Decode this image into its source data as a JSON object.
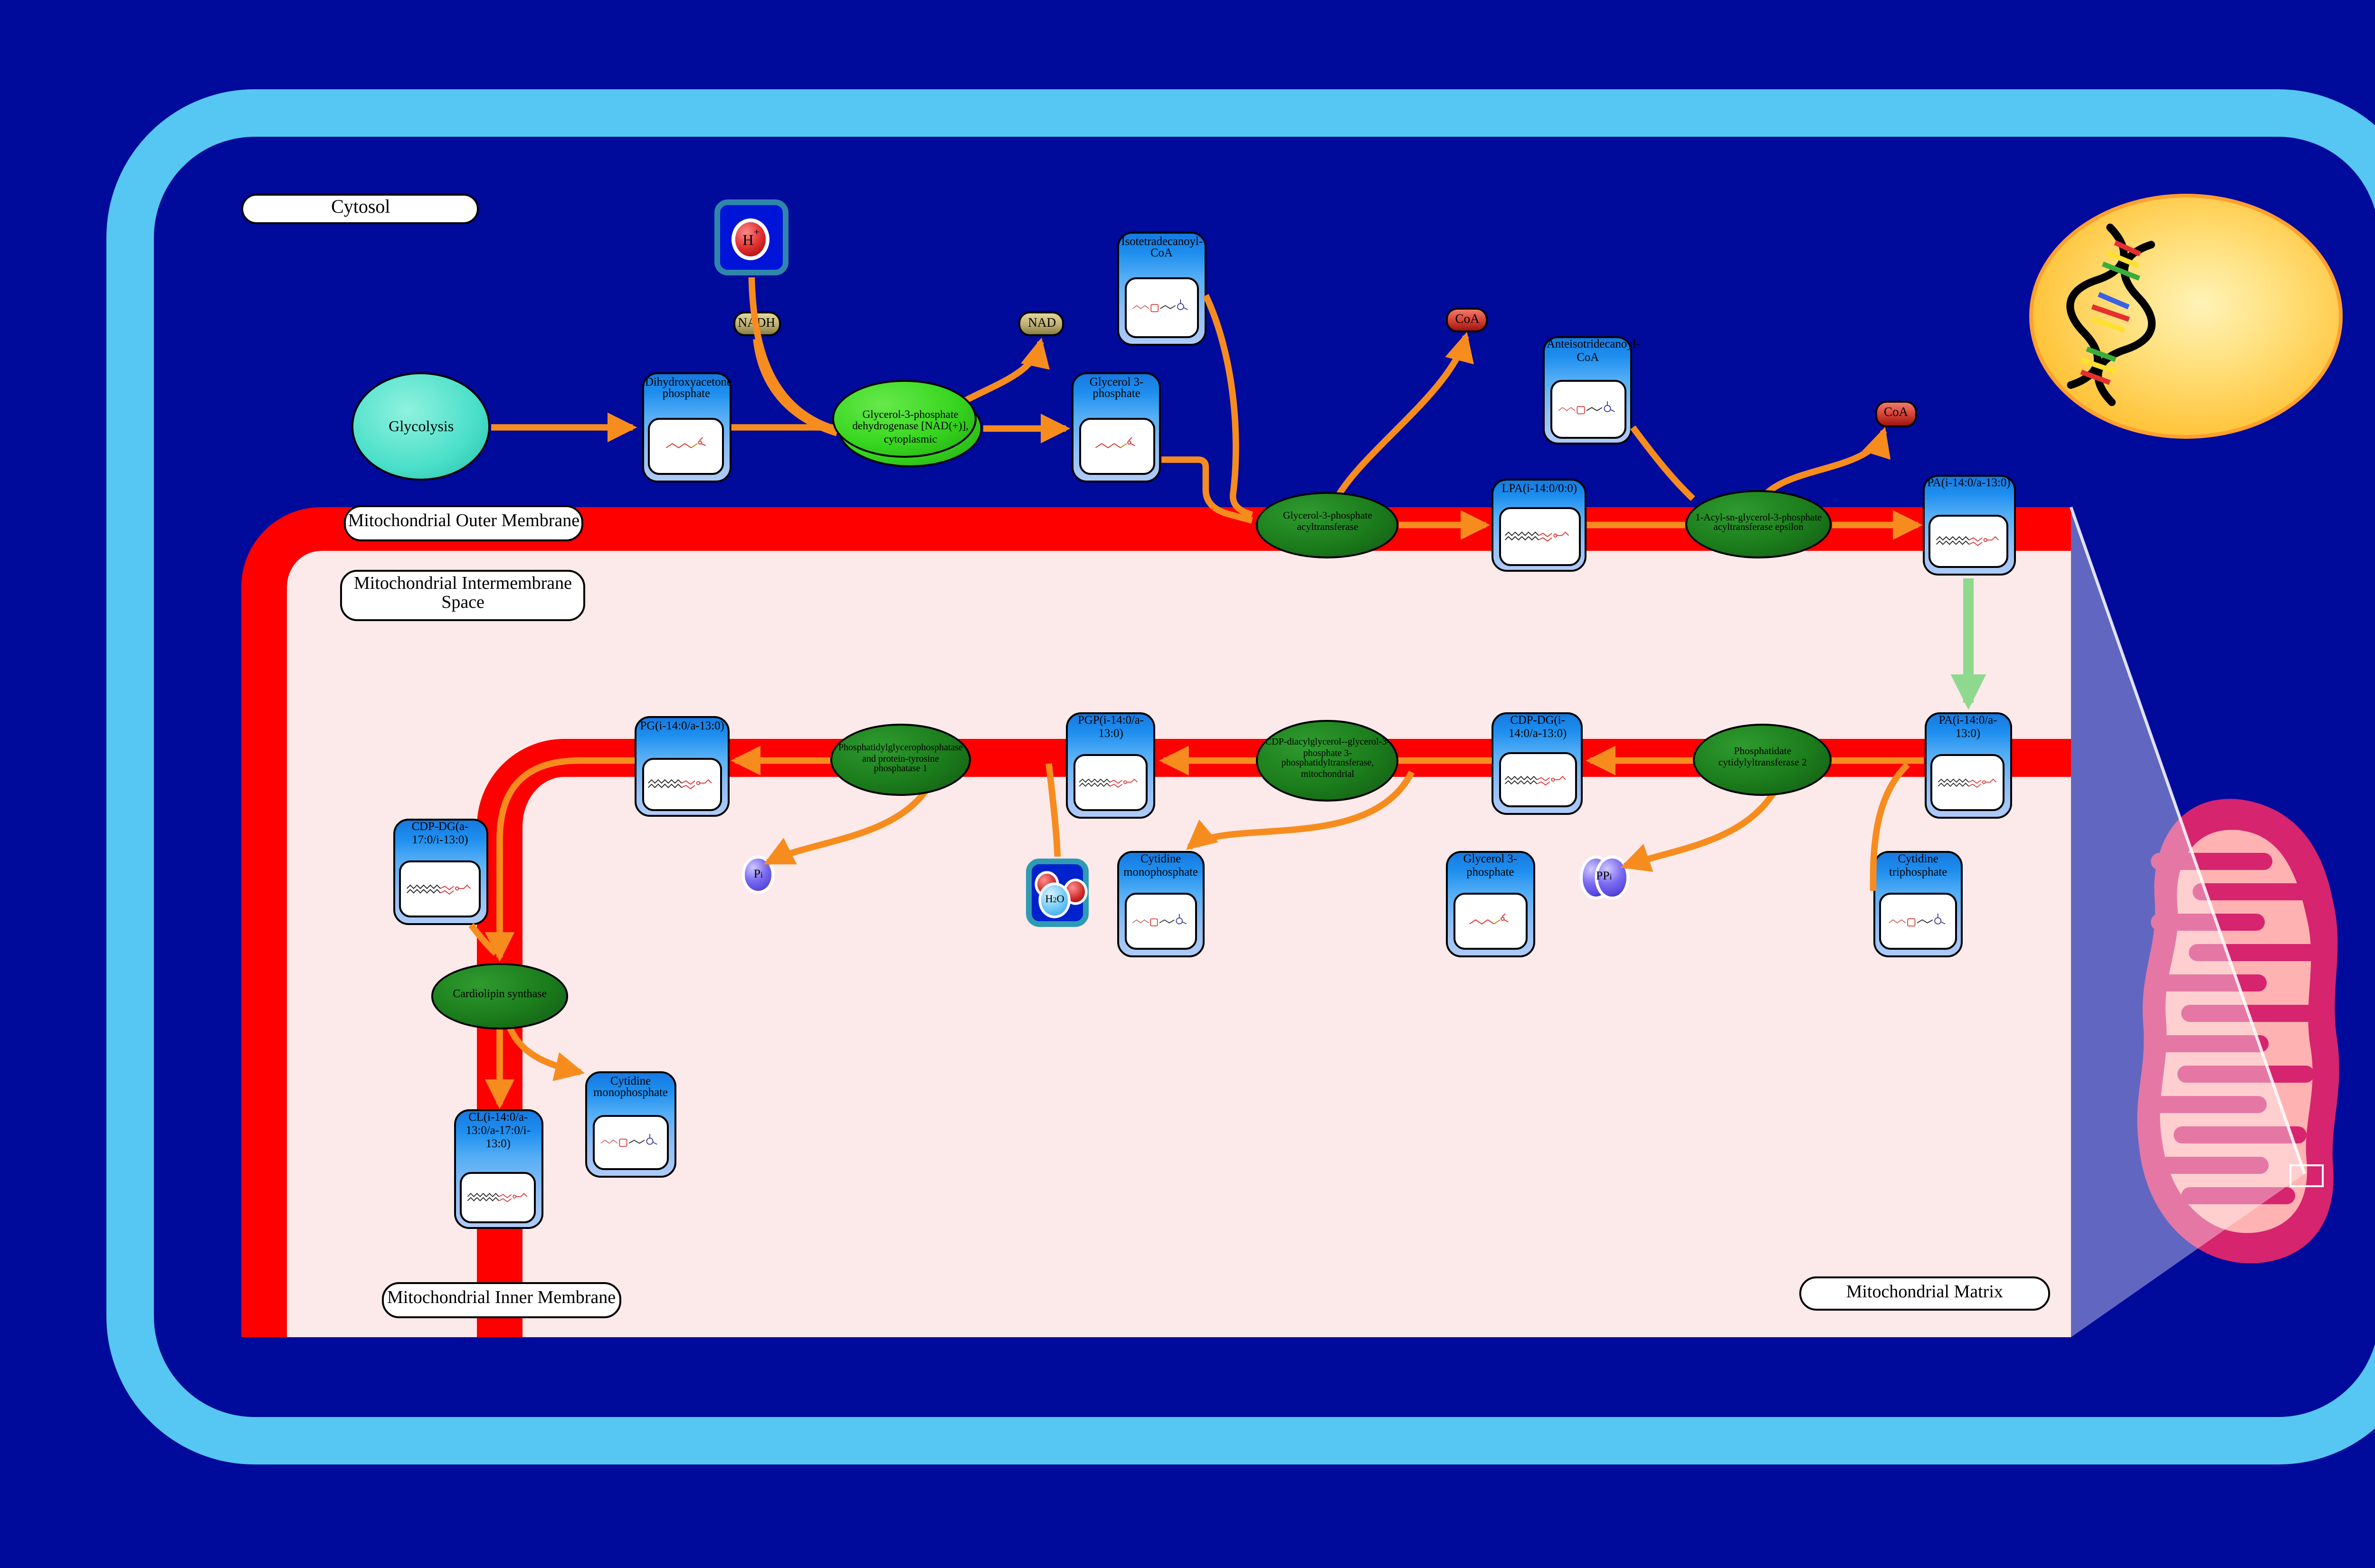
{
  "compartments": {
    "cytosol": "Cytosol",
    "outer_membrane": "Mitochondrial Outer Membrane",
    "intermembrane_space": "Mitochondrial Intermembrane Space",
    "inner_membrane": "Mitochondrial Inner Membrane",
    "matrix": "Mitochondrial Matrix"
  },
  "process": {
    "glycolysis": "Glycolysis"
  },
  "enzymes": {
    "gpd1": "Glycerol-3-phosphate dehydrogenase [NAD(+)], cytoplasmic",
    "gpat": "Glycerol-3-phosphate acyltransferase",
    "agpat_epsilon": "1-Acyl-sn-glycerol-3-phosphate acyltransferase epsilon",
    "cds2": "Phosphatidate cytidylyltransferase 2",
    "pgs1": "CDP-diacylglycerol--glycerol-3-phosphate 3-phosphatidyltransferase, mitochondrial",
    "ptpmt1": "Phosphatidylglycerophosphatase and protein-tyrosine phosphatase 1",
    "crls1": "Cardiolipin synthase"
  },
  "species": {
    "dhap": "Dihydroxyacetone phosphate",
    "g3p_cytosol": "Glycerol 3-phosphate",
    "iso_coa": "Isotetradecanoyl-CoA",
    "anteiso_coa": "Anteisotridecanoyl-CoA",
    "lpa": "LPA(i-14:0/0:0)",
    "pa_outer": "PA(i-14:0/a-13:0)",
    "pa_matrix": "PA(i-14:0/a-13:0)",
    "cdp_dg": "CDP-DG(i-14:0/a-13:0)",
    "pgp": "PGP(i-14:0/a-13:0)",
    "pg": "PG(i-14:0/a-13:0)",
    "cdp_dg_a": "CDP-DG(a-17:0/i-13:0)",
    "cl": "CL(i-14:0/a-13:0/a-17:0/i-13:0)",
    "cmp_center": "Cytidine monophosphate",
    "cmp_left": "Cytidine monophosphate",
    "g3p_matrix": "Glycerol 3-phosphate",
    "ctp": "Cytidine triphosphate"
  },
  "metabolites": {
    "nadh": "NADH",
    "nad": "NAD",
    "coa_outer_left": "CoA",
    "coa_outer_right": "CoA",
    "h_plus": {
      "base": "H",
      "sup": "+"
    },
    "h2o": {
      "pre": "H",
      "sub": "2",
      "post": "O"
    },
    "pi": {
      "base": "P",
      "sub": "i"
    },
    "ppi": {
      "base": "PP",
      "sub": "i"
    }
  },
  "colors": {
    "bg_navy": "#000A9B",
    "cell_blue": "#56C6F2",
    "matrix_pink": "#FCE9E9",
    "membrane_red": "#FF0000",
    "accent_orange": "#F78C1E",
    "green_arrow": "#8FD98F",
    "enzyme_dark": "#1B7C1B",
    "enzyme_bright": "#38D620",
    "species_header": "#1E8FEF",
    "species_body": "#AECBF9",
    "node_tan_light": "#E3D79B",
    "node_tan_dark": "#877B49",
    "node_red": "#C62828",
    "node_purple": "#5B4BE0",
    "nucleus_yellow": "#FFC53D",
    "nucleus_edge": "#FF9F2E",
    "mito_outer": "#D6246E",
    "mito_inner": "#FFB2B2"
  }
}
